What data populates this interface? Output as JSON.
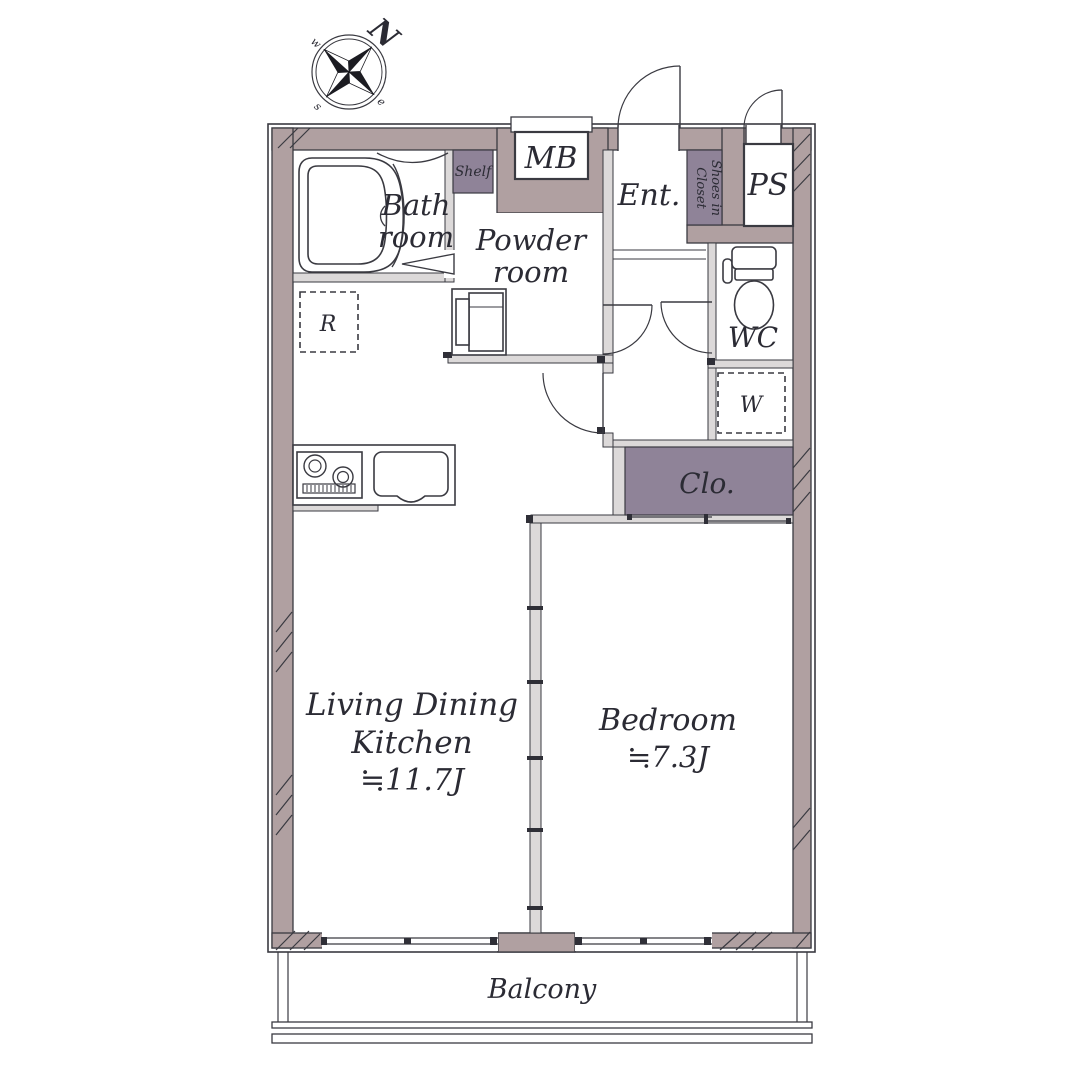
{
  "compass": {
    "n": "N",
    "w": "w",
    "s": "s",
    "e": "e"
  },
  "rooms": {
    "bath": {
      "line1": "Bath",
      "line2": "room"
    },
    "powder": {
      "line1": "Powder",
      "line2": "room"
    },
    "mb": "MB",
    "shelf": "Shelf",
    "ent": "Ent.",
    "shoes_closet": {
      "line1": "Shoes in",
      "line2": "Closet"
    },
    "ps": "PS",
    "wc": "WC",
    "washer": "W",
    "fridge": "R",
    "closet": "Clo.",
    "ldk": {
      "line1": "Living Dining",
      "line2": "Kitchen",
      "size": "≒11.7J"
    },
    "bedroom": {
      "name": "Bedroom",
      "size": "≒7.3J"
    },
    "balcony": "Balcony"
  },
  "colors": {
    "wall": "#b0a0a1",
    "storage": "#8f8398",
    "outline": "#3a3a41",
    "text": "#2b2b34",
    "thin_wall": "#dcd9d9"
  }
}
